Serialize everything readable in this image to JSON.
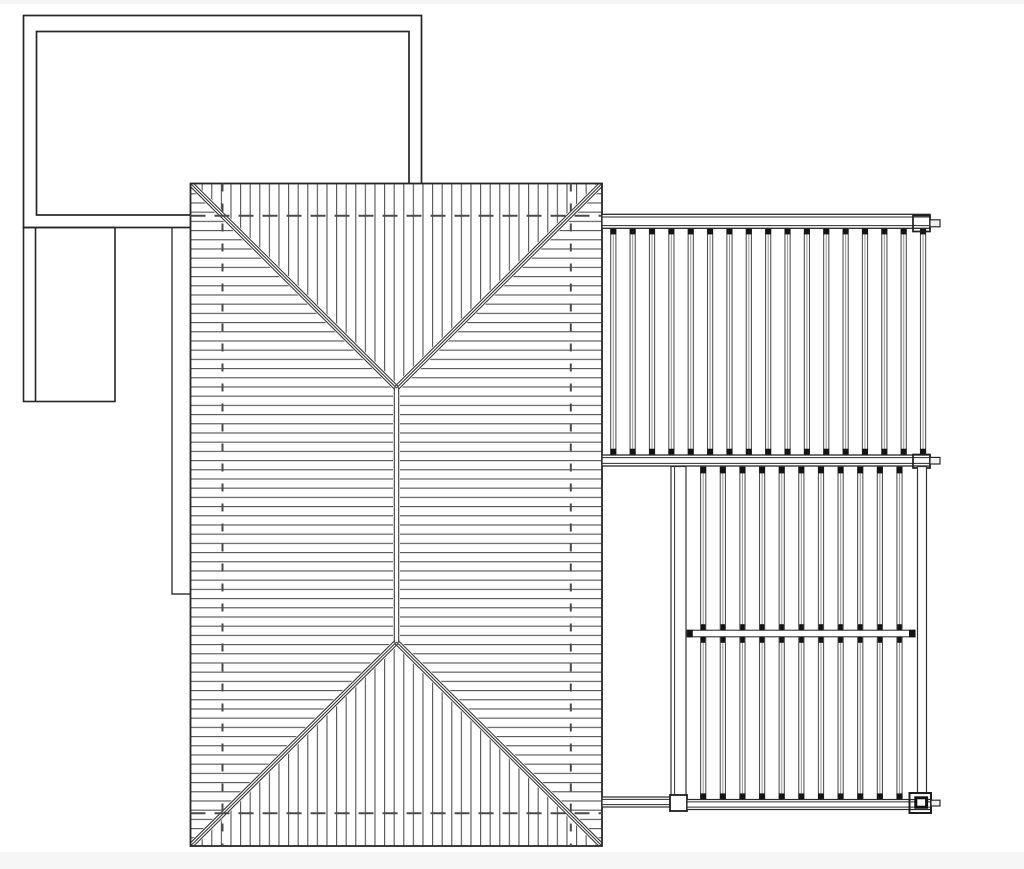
{
  "document": {
    "type": "architectural-roof-plan",
    "view": "top-down plan",
    "style": "monochrome CAD line drawing",
    "text_content": "none"
  },
  "canvas": {
    "width": 1024,
    "height": 869,
    "background": "#ffffff",
    "footer_strip_color": "#f6f6f7",
    "top_strip_color": "#f5f5f6"
  },
  "palette": {
    "outline": "#262626",
    "medium_line": "#3a3a3a",
    "hatch_line": "#5a5a5a",
    "hidden_dash": "#4a4a4a",
    "slat_edge": "#4f4f4f",
    "slat_center": "#9a9a9a",
    "slat_fill": "#fbfbfb",
    "tip_black": "#141414",
    "white": "#ffffff"
  },
  "roof": {
    "component": "hip-roof",
    "planes": [
      "north-vertical-hatch",
      "south-vertical-hatch",
      "west-horizontal-hatch",
      "east-horizontal-hatch"
    ],
    "hip_count": 4,
    "ridge_count": 1,
    "hatch": {
      "horizontal_spacing": 9.2,
      "vertical_spacing": 9.6,
      "line_width": 1.15
    },
    "hidden_wall_lines": {
      "horizontal_count": 2,
      "vertical_count": 2
    }
  },
  "upper_pergola": {
    "component": "slatted-deck-section",
    "slats": {
      "count": 17,
      "first_center_x": 613.3,
      "spacing": 19.36,
      "top_y": 227.8,
      "bottom_y": 455.3,
      "body_width": 5.2,
      "tip_height": 6.6
    }
  },
  "lower_pergola": {
    "component": "slatted-deck-section",
    "slats": {
      "count": 11,
      "first_center_x": 703.2,
      "spacing": 19.63,
      "top_y": 466.8,
      "bottom_y": 800.0,
      "body_width": 5.2,
      "tip_height": 6.6
    },
    "mid_rail": {
      "x_start": 687,
      "x_end": 915,
      "y_top": 630.2,
      "y_bottom": 636.8,
      "mark_width": 4.4,
      "mark_height": 6.0
    }
  }
}
